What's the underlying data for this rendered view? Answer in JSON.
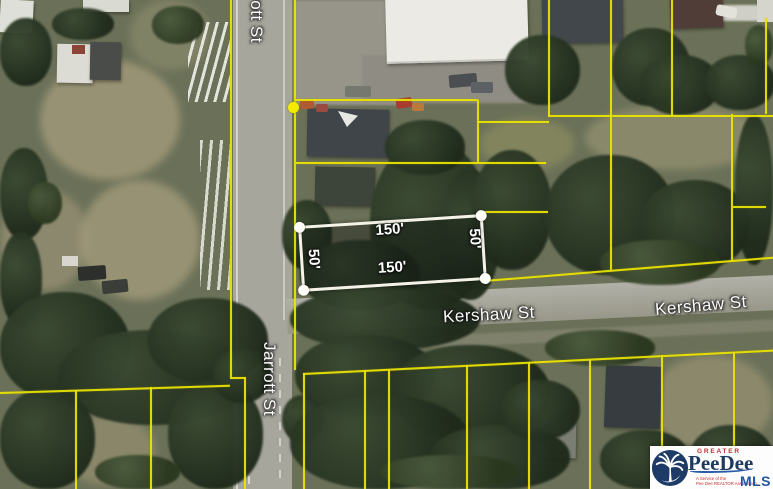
{
  "map": {
    "street_names": {
      "jarrott": "Jarrott St",
      "kershaw": "Kershaw St"
    },
    "highlighted_parcel": {
      "frontage": "150'",
      "depth": "50'",
      "outline_color": "#f5f2e7",
      "fill": "rgba(20,24,18,0.42)"
    },
    "boundary_line_color": "#ece504"
  },
  "logo": {
    "top_text": "GREATER",
    "name": "PeeDee",
    "mls": "MLS",
    "tagline_line1": "A Service of the",
    "tagline_line2": "Pee Dee REALTOR Association",
    "colors": {
      "navy": "#1e3a5e",
      "red": "#c22d30",
      "blue": "#2155a0"
    }
  }
}
